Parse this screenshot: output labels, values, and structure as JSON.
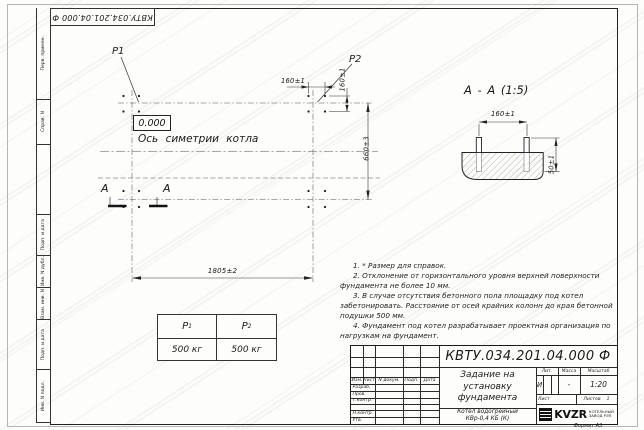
{
  "stamp": {
    "doc_number": "КВТУ.034.201.04.000  Ф"
  },
  "sidebar": {
    "items": [
      "Перв. примен.",
      "Справ. N",
      "",
      "Подп. и дата",
      "Инв. N дубл.",
      "Взам. инв. N",
      "Подп. и дата",
      "Инв. N подл."
    ]
  },
  "plan": {
    "p1_label": "P1",
    "p2_label": "P2",
    "elevation": "0.000",
    "axis_label": "Ось симетрии котла",
    "dim_length": "1805±2",
    "dim_width": "660±3",
    "dim_group_horizontal": "160±1",
    "dim_group_vertical": "160±1",
    "section_letter": "А"
  },
  "section_view": {
    "title": "А - А (1:5)",
    "dim_bolt_spacing": "160±1",
    "dim_bolt_height": "50±1"
  },
  "notes": [
    "1. * Размер для справок.",
    "2. Отклонение от горизонтального уровня верхней поверхности фундамента не более 10 мм.",
    "3. В случае отсутствия бетонного пола площадку под котел забетонировать. Расстояние от осей крайних колонн до края бетонной подушки 500 мм.",
    "4. Фундамент под котел разрабатывает проектная организация по нагрузкам на фундамент."
  ],
  "load_table": {
    "headers": [
      {
        "base": "P",
        "sub": "1"
      },
      {
        "base": "P",
        "sub": "2"
      }
    ],
    "values": [
      "500 кг",
      "500 кг"
    ]
  },
  "title_block": {
    "doc_number": "КВТУ.034.201.04.000  Ф",
    "title_lines": [
      "Задание на",
      "установку",
      "фундамента"
    ],
    "product_lines": [
      "Котел водогрейный",
      "КВр-0,4  КБ  (К)"
    ],
    "rev_headers": [
      "Изм.",
      "Лист",
      "N докум.",
      "Подп.",
      "Дата"
    ],
    "row_labels": [
      "Разраб.",
      "Пров.",
      "Т.контр.",
      "",
      "Н.контр.",
      "Утв."
    ],
    "lit_header": "Лит.",
    "mass_header": "Масса",
    "scale_header": "Масштаб",
    "lit_value": "И",
    "mass_value": "-",
    "scale_value": "1:20",
    "sheet_label": "Лист",
    "sheets_label": "Листов",
    "sheets_value": "1",
    "logo_text": "KVZR",
    "logo_sub1": "КОТЕЛЬНЫЙ",
    "logo_sub2": "ЗАВОД РЭП",
    "format_label": "Формат А3"
  },
  "colors": {
    "line": "#333333",
    "text": "#1a1a1a",
    "frame": "#222222"
  }
}
